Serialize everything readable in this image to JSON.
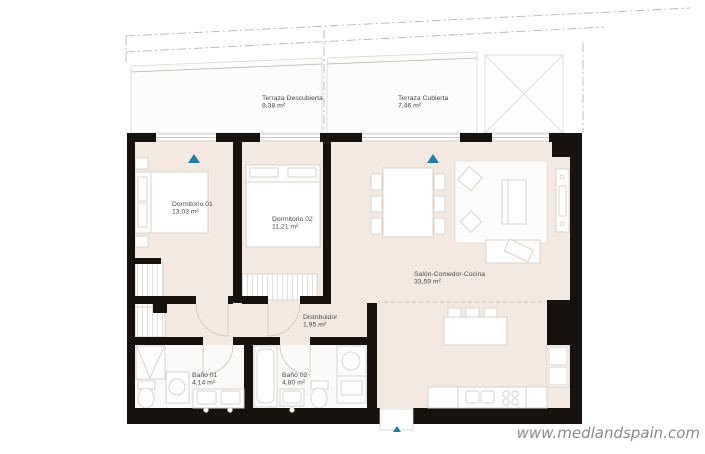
{
  "meta": {
    "type": "apartment-floor-plan",
    "watermark": "www.medlandspain.com"
  },
  "colors": {
    "wall": "#17120e",
    "floor": "#f4e9e1",
    "terrace_floor": "#fcfcfa",
    "entrance_marker": "#1f7fa7",
    "label_text": "#4a4a4a",
    "watermark_text": "#8f8b86"
  },
  "rooms": {
    "terraza_descubierta": {
      "name": "Terraza Descubierta",
      "area": "8,38 m²"
    },
    "terraza_cubierta": {
      "name": "Terraza Cubierta",
      "area": "7,46 m²"
    },
    "dormitorio_01": {
      "name": "Dormitorio 01",
      "area": "13,03 m²"
    },
    "dormitorio_02": {
      "name": "Dormitorio 02",
      "area": "11,21 m²"
    },
    "salon_comedor_cocina": {
      "name": "Salón-Comedor-Cocina",
      "area": "33,59 m²"
    },
    "distribuidor": {
      "name": "Distribuidor",
      "area": "1,95 m²"
    },
    "bano_01": {
      "name": "Baño 01",
      "area": "4,14 m²"
    },
    "bano_02": {
      "name": "Baño 02",
      "area": "4,80 m²"
    }
  }
}
